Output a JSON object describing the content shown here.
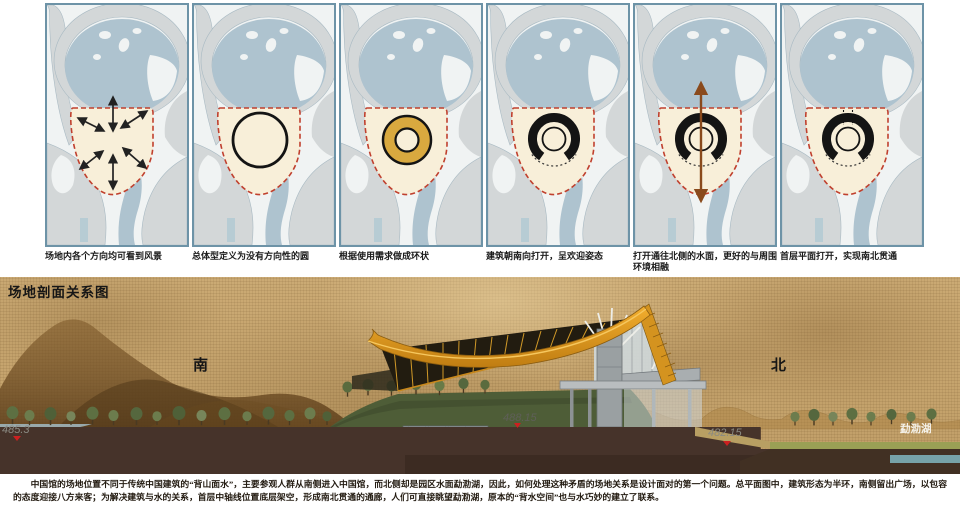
{
  "diagram_panels": {
    "captions": [
      "场地内各个方向均可看到风景",
      "总体型定义为没有方向性的圆",
      "根据使用需求做成环状",
      "建筑朝南向打开，呈欢迎姿态",
      "打开通往北侧的水面，更好的与周围环境相融",
      "首层平面打开，实现南北贯通"
    ]
  },
  "section": {
    "title": "场地剖面关系图",
    "label_south": "南",
    "label_north": "北",
    "elevation_left": "485.3",
    "elevation_plaza": "488.15",
    "elevation_right": "482.15",
    "lake_label": "勐泐湖"
  },
  "body_text": "　　中国馆的场地位置不同于传统中国建筑的“背山面水”，主要参观人群从南侧进入中国馆，而北侧却是园区水面勐泐湖，因此，如何处理这种矛盾的场地关系是设计面对的第一个问题。总平面图中，建筑形态为半环，南侧留出广场，以包容的态度迎接八方来客；为解决建筑与水的关系，首层中轴线位置底层架空，形成南北贯通的通廊，人们可直接眺望勐泐湖，原本的“背水空间”也与水巧妙的建立了联系。",
  "colors": {
    "panel_border": "#6d93a7",
    "map_water": "#aec3cf",
    "map_land": "#d3d7d8",
    "site_fill": "#f8efd9",
    "site_outline": "#c0402e",
    "ring_gold": "#d9a93f",
    "axis_arrow_brown": "#8a4a1c",
    "roof_gold": "#e09a22",
    "parchment": "#c9a873",
    "soil_brown": "#46332a",
    "elevation_marker_red": "#cc2020"
  }
}
